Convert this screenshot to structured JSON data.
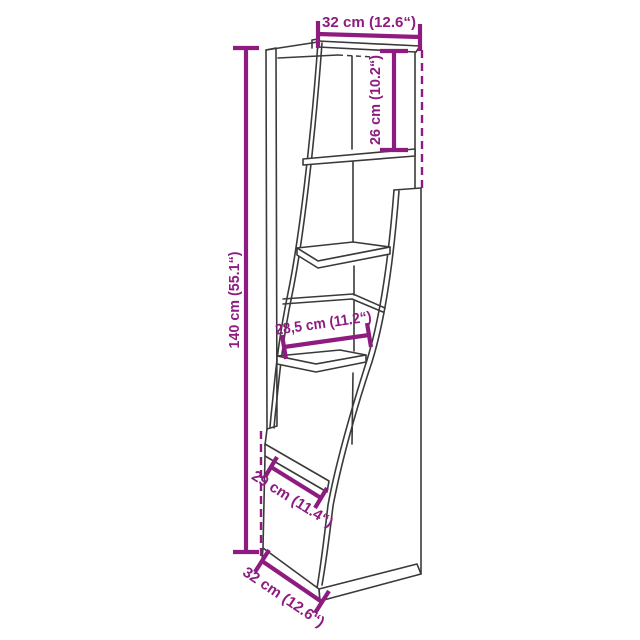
{
  "diagram": {
    "name": "corner-shelf-dimension-diagram",
    "colors": {
      "dimension": "#8e1c80",
      "line_art": "#3a3a3a",
      "background": "#ffffff"
    },
    "dimensions": [
      {
        "id": "top-width",
        "label": "32 cm (12.6“)"
      },
      {
        "id": "upper-compartment-height",
        "label": "26 cm (10.2“)"
      },
      {
        "id": "overall-height",
        "label": "140 cm (55.1“)"
      },
      {
        "id": "middle-shelf-width",
        "label": "28,5 cm (11.2“)"
      },
      {
        "id": "lower-shelf-width",
        "label": "29 cm (11.4“)"
      },
      {
        "id": "base-depth",
        "label": "32 cm (12.6“)"
      }
    ]
  }
}
